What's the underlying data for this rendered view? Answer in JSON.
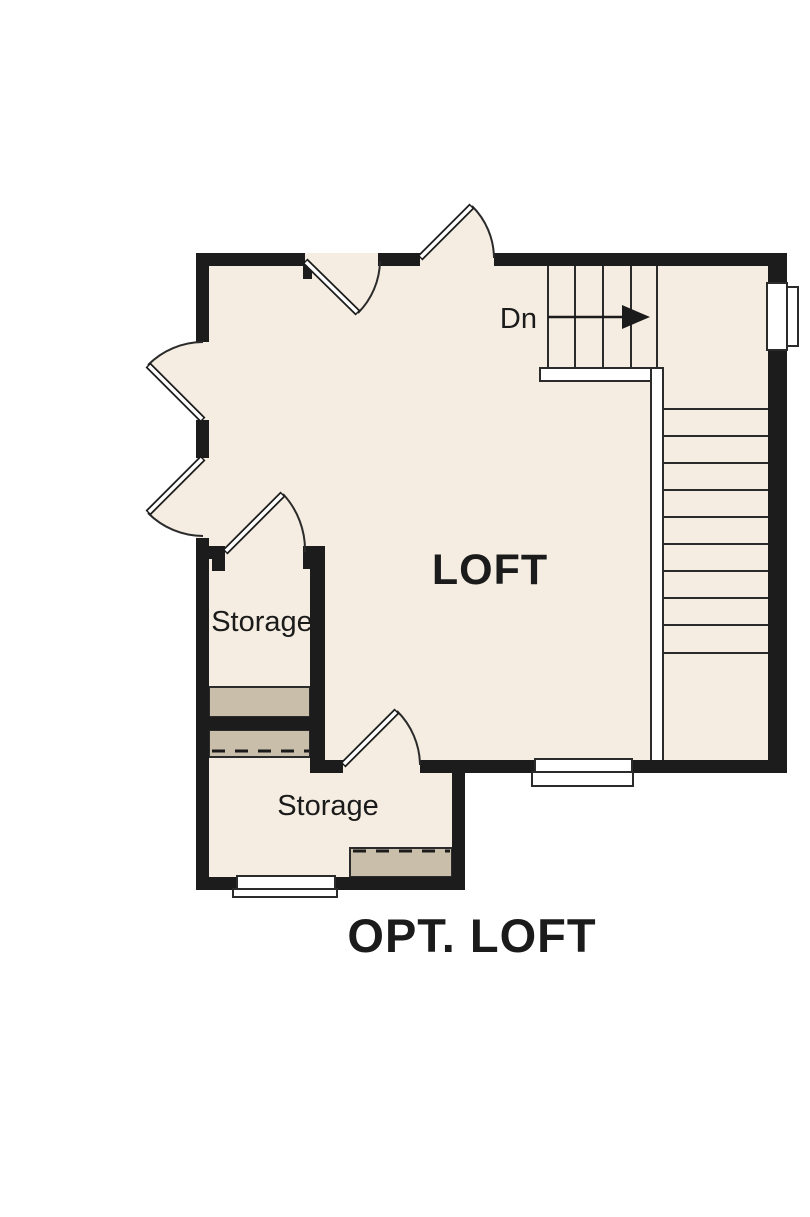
{
  "colors": {
    "wall": "#1c1c1c",
    "floor": "#f5ede1",
    "attic": "#c9bea9",
    "line": "#2b2b2b",
    "paper": "#ffffff",
    "ink": "#1b1b1b"
  },
  "plan": {
    "title": "OPT. LOFT",
    "rooms": [
      {
        "id": "loft",
        "label": "LOFT"
      },
      {
        "id": "storage-upper",
        "label": "Storage"
      },
      {
        "id": "storage-lower",
        "label": "Storage"
      }
    ],
    "stairs": {
      "down_label": "Dn"
    }
  }
}
